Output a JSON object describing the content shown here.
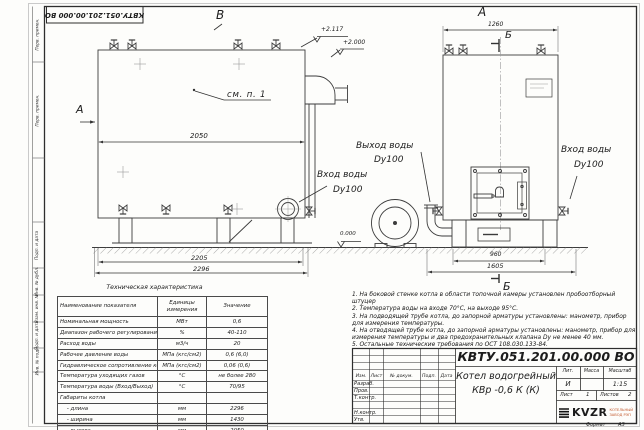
{
  "frame": {
    "left_strip": [
      "Перв. примен.",
      "Перв. примен.",
      "Подп. и дата",
      "Инв. № дубл.",
      "Взам. инв. №",
      "Подп. и дата",
      "Инв. № подл."
    ]
  },
  "drawing": {
    "view_b": {
      "label": "В",
      "section_arrow_label": "А",
      "see_note": "см. п. 1",
      "dim_length": "2050",
      "dim_base": "2205",
      "dim_total": "2296",
      "elev_top": "+2.117",
      "elev_mid": "+2.000",
      "elev_zero": "0.000",
      "outlet_line1": "Выход воды",
      "outlet_line2": "Dy100",
      "inlet_line1": "Вход воды",
      "inlet_line2": "Dy100"
    },
    "view_a": {
      "label": "А",
      "section_top": "Б",
      "section_bottom": "Б",
      "dim_width": "1260",
      "dim_base": "960",
      "dim_total": "1605",
      "inlet_line1": "Вход воды",
      "inlet_line2": "Dy100"
    }
  },
  "tech_table": {
    "title": "Техническая характеристика",
    "headers": [
      "Наименование показателя",
      "Единицы измерения",
      "Значение"
    ],
    "rows": [
      [
        "Номинальная мощность",
        "МВт",
        "0,6"
      ],
      [
        "Диапазон рабочего регулирования",
        "%",
        "40-110"
      ],
      [
        "Расход воды",
        "м3/ч",
        "20"
      ],
      [
        "Рабочее давление воды",
        "МПа (кгс/см2)",
        "0,6 (6,0)"
      ],
      [
        "Гидравлическое сопротивление котла",
        "МПа (кгс/см2)",
        "0,06 (0,6)"
      ],
      [
        "Температура уходящих газов",
        "°С",
        "не более 280"
      ],
      [
        "Температура воды (Вход/Выход)",
        "°С",
        "70/95"
      ],
      [
        "Габариты котла",
        "",
        ""
      ],
      [
        "    - длина",
        "мм",
        "2296"
      ],
      [
        "    - ширина",
        "мм",
        "1430"
      ],
      [
        "    - высота",
        "мм",
        "2050"
      ]
    ]
  },
  "notes": [
    "1.  На боковой стенке котла в области топочной камеры установлен пробоотборный штуцер",
    "2.  Температура воды на входе 70°С, на выходе 95°С.",
    "3.  На подводящей трубе котла, до запорной арматуры установлены: манометр, прибор для измерения температуры.",
    "4.  На отводящей трубе котла, до запорной арматуры установлены: манометр, прибор для измерения температуры и два предохранительных клапана Dу не менее 40 мм.",
    "5.  Остальные технические требования по ОСТ 108.030.133-84."
  ],
  "title_block": {
    "doc_number": "КВТУ.051.201.00.000  ВО",
    "product_name_1": "Котел водогрейный",
    "product_name_2": "КВр -0,6  К  (К)",
    "col_headers": [
      "Изм.",
      "Лист",
      "№ докум.",
      "Подп.",
      "Дата"
    ],
    "row_labels": [
      "Разраб.",
      "Пров.",
      "Т.контр.",
      "",
      "Н.контр.",
      "Утв."
    ],
    "lit_header": "Лит.",
    "lit_value": "И",
    "mass_header": "Масса",
    "scale_header": "Масштаб",
    "scale_value": "1:15",
    "sheet_label": "Лист",
    "sheet_value": "1",
    "sheets_label": "Листов",
    "sheets_value": "2",
    "logo_text": "KVZR",
    "logo_sub_1": "КОТЕЛЬНЫЙ",
    "logo_sub_2": "ЗАВОД РЭП",
    "format_label": "Формат",
    "format_value": "А3"
  }
}
